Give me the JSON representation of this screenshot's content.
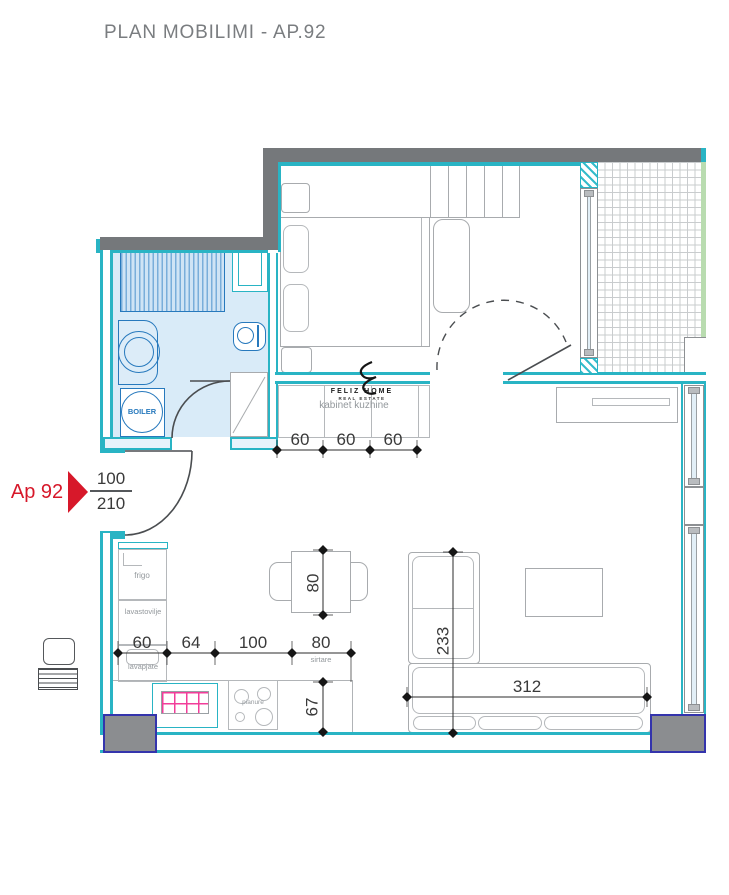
{
  "title": "PLAN MOBILIMI - AP.92",
  "entry": {
    "marker": "Ap 92",
    "door_width": "100",
    "door_height": "210"
  },
  "labels": {
    "boiler": "BOILER",
    "fridge": "frigo",
    "dishwasher": "lavastovilje",
    "sink": "lavapjate",
    "cooktop": "pianure",
    "drawers": "sirtare",
    "kitchen_cabinet": "kabinet kuzhine"
  },
  "logo": {
    "name": "FELIZ HOME",
    "subtitle": "REAL ESTATE"
  },
  "dimensions": {
    "kitchen_row": [
      "60",
      "64",
      "100",
      "80"
    ],
    "cabinet_row": [
      "60",
      "60",
      "60"
    ],
    "table_depth": "80",
    "counter_depth": "67",
    "sofa_depth": "233",
    "sofa_width": "312"
  },
  "colors": {
    "wall_gray": "#75787b",
    "wall_cyan": "#29b4c4",
    "bathroom_floor": "#d9ebf8",
    "fixture_blue": "#2779bd",
    "marker_red": "#d7182a",
    "sink_grid_pink": "#f23d9a",
    "column_border_navy": "#3434ac",
    "balcony_edge_green": "#b9dcb0"
  }
}
